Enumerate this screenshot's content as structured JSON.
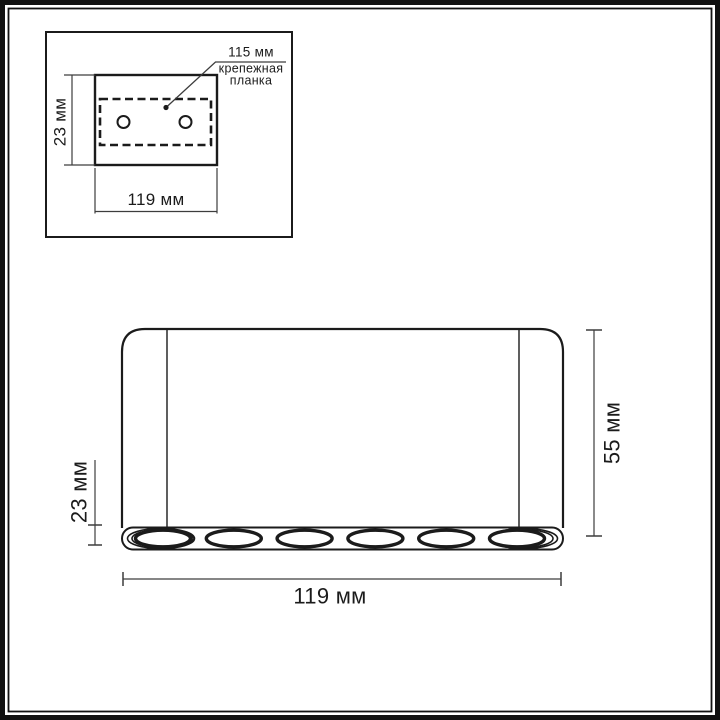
{
  "figure": {
    "type": "technical-dimension-drawing",
    "units": "мм"
  },
  "inset_top_view": {
    "plate_depth_label": "23 мм",
    "plate_width_label": "119 мм",
    "bracket_length_label": "115 мм",
    "bracket_caption_lines": [
      "крепежная",
      "планка"
    ],
    "mounting_hole_count": 2
  },
  "front_view": {
    "body_height_label": "55 мм",
    "body_width_label": "119 мм",
    "trim_height_label": "23 мм",
    "led_spot_count": 6
  },
  "colors": {
    "background": "#ffffff",
    "drawing_line": "#1b1b1b",
    "dimension_line": "#3d3d3d",
    "frame": "#101010"
  }
}
